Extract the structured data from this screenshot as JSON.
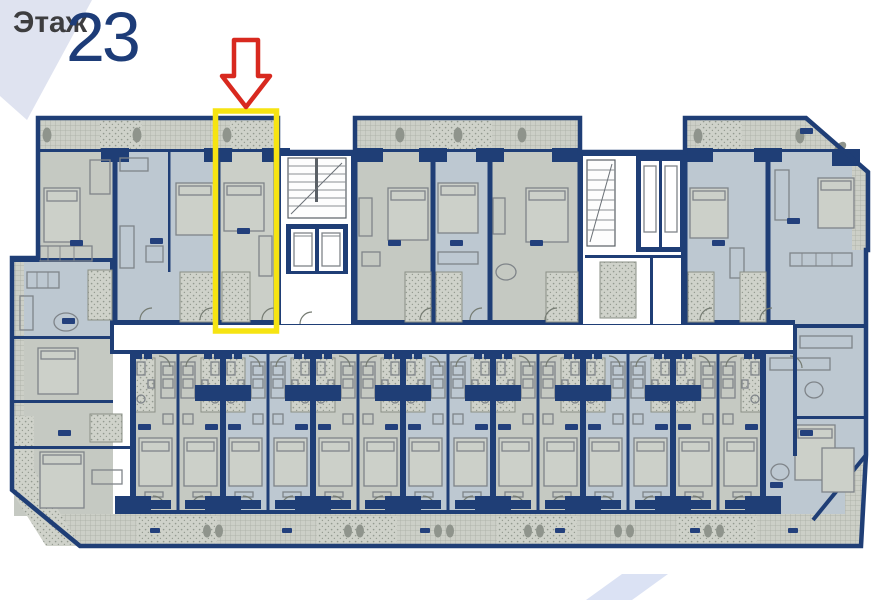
{
  "header": {
    "floor_label": "Этаж",
    "floor_number": "23"
  },
  "overlays": {
    "highlight_color": "#f6e412",
    "arrow_color": "#d8291f",
    "highlighted_unit": "top-row unit under red arrow"
  },
  "plan_colors": {
    "wall": "#1f3e76",
    "floor_gray": "#c5c9c2",
    "floor_blue": "#bdc8d1",
    "floor_pale": "#cbcfc8",
    "balcony": "#cccfc7",
    "corridor": "#ffffff",
    "header_band": "#dfe3f0",
    "deco_shape": "#dbe2f4"
  }
}
